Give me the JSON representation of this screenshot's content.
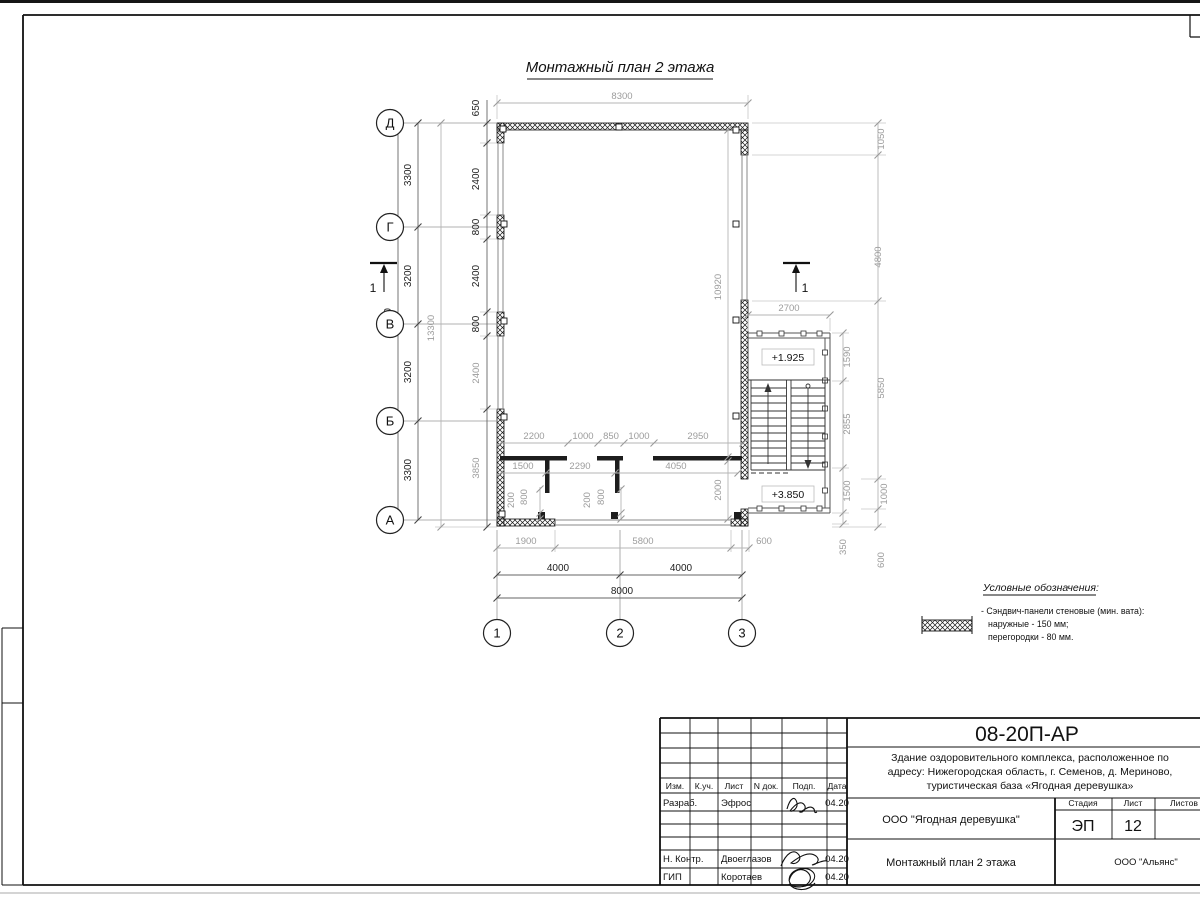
{
  "drawing": {
    "title": "Монтажный план 2 этажа"
  },
  "axes": {
    "rows": [
      "Д",
      "Г",
      "В",
      "Б",
      "А"
    ],
    "cols": [
      "1",
      "2",
      "3"
    ]
  },
  "section": {
    "label": "1"
  },
  "elevations": {
    "mid_landing": "+1.925",
    "floor": "+3.850"
  },
  "dims": {
    "top_width": "8300",
    "left_total": "13000",
    "left_axis": [
      "3300",
      "3200",
      "3200",
      "3300"
    ],
    "left_overall": "13300",
    "left_panels": [
      "650",
      "2400",
      "800",
      "2400",
      "800",
      "2400",
      "3850"
    ],
    "interior_top": [
      "2200",
      "1000",
      "850",
      "1000",
      "2950"
    ],
    "interior_rooms": [
      "1500",
      "2290",
      "4050"
    ],
    "interior_height": "10920",
    "interior_right": "2000",
    "door1": [
      "200",
      "800"
    ],
    "door2": [
      "200",
      "800"
    ],
    "bottom_segments": [
      "1900",
      "5800",
      "600"
    ],
    "bottom_axis": [
      "4000",
      "4000"
    ],
    "bottom_total": "8000",
    "stair_width": "2700",
    "stair_inner": [
      "1590",
      "2855",
      "1500",
      "350"
    ],
    "right_outer": [
      "1050",
      "4800",
      "5850",
      "1000",
      "600"
    ]
  },
  "legend": {
    "heading": "Условные обозначения:",
    "line1": "- Сэндвич-панели стеновые (мин. вата):",
    "line2": "наружные - 150 мм;",
    "line3": "перегородки - 80 мм."
  },
  "titleblock": {
    "doc_number": "08-20П-АР",
    "project_line1": "Здание оздоровительного комплекса, расположенное по",
    "project_line2": "адресу: Нижегородская область, г. Семенов, д. Мериново,",
    "project_line3": "туристическая база «Ягодная деревушка»",
    "client": "ООО \"Ягодная деревушка\"",
    "sheet_title": "Монтажный план 2 этажа",
    "contractor": "ООО \"Альянс\"",
    "stage_label": "Стадия",
    "sheet_label": "Лист",
    "sheets_label": "Листов",
    "stage": "ЭП",
    "sheet_number": "12",
    "columns": [
      "Изм.",
      "К.уч.",
      "Лист",
      "N док.",
      "Подп.",
      "Дата"
    ],
    "rows": [
      {
        "role": "Разраб.",
        "name": "Эфрос",
        "date": "04.20"
      },
      {
        "role": "Н. Контр.",
        "name": "Двоеглазов",
        "date": "04.20"
      },
      {
        "role": "ГИП",
        "name": "Коротаев",
        "date": "04.20"
      }
    ]
  }
}
